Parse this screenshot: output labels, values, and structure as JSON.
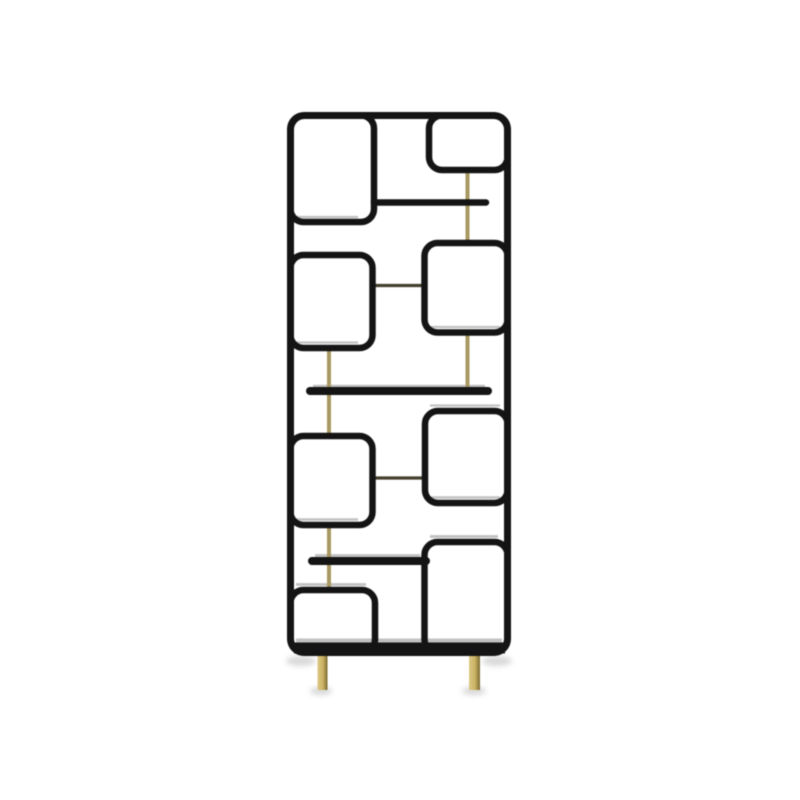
{
  "image": {
    "description": "Studio product photo of a mid-century modern room divider shelf: a tall black rounded rectangular frame containing eight rounded-corner compartments of varying sizes, three floating black shelves, slender light-brass vertical support rods, two short dark connector rods, and two brass legs, standing on a plain white background with soft floor shadows."
  },
  "palette": {
    "background": "#ffffff",
    "frame_black": "#141414",
    "brass": "#a89861",
    "connector_dark": "#45402e",
    "leg_gradient": [
      "#dcc987",
      "#c9b263",
      "#7b682f"
    ],
    "depth_gray": "#8f8f8f",
    "shadow_gray": "#bfbfbf"
  },
  "scene": {
    "canvas": {
      "width": 800,
      "height": 800
    },
    "frame": {
      "x": 290.5,
      "y": 115.5,
      "w": 217,
      "h": 537,
      "rx": 14,
      "stroke": 7
    },
    "base_rail": {
      "x1": 294,
      "y1": 648,
      "x2": 505,
      "y2": 648,
      "stroke": 11
    },
    "boxes": [
      {
        "name": "compartment-top-left",
        "x": 290.5,
        "y": 115.5,
        "w": 83.5,
        "h": 106.5,
        "rx": 13
      },
      {
        "name": "compartment-top-right",
        "x": 429.0,
        "y": 115.5,
        "w": 78.5,
        "h": 54.5,
        "rx": 13
      },
      {
        "name": "compartment-mid-left",
        "x": 290.5,
        "y": 255.0,
        "w": 82.0,
        "h": 93.0,
        "rx": 13
      },
      {
        "name": "compartment-mid-right",
        "x": 424.5,
        "y": 243.0,
        "w": 83.0,
        "h": 89.5,
        "rx": 13
      },
      {
        "name": "compartment-lower-left",
        "x": 290.5,
        "y": 436.0,
        "w": 82.0,
        "h": 89.0,
        "rx": 13
      },
      {
        "name": "compartment-lower-right",
        "x": 425.0,
        "y": 411.0,
        "w": 82.5,
        "h": 92.0,
        "rx": 13
      },
      {
        "name": "compartment-bottom-left",
        "x": 290.5,
        "y": 590.0,
        "w": 84.5,
        "h": 62.5,
        "rx": 13
      },
      {
        "name": "compartment-bottom-right",
        "x": 424.5,
        "y": 542.0,
        "w": 83.0,
        "h": 110.5,
        "rx": 13
      }
    ],
    "shelves": [
      {
        "name": "shelf-top",
        "x1": 374,
        "y1": 202.5,
        "x2": 486,
        "y2": 202.5,
        "stroke": 6.5
      },
      {
        "name": "shelf-middle",
        "x1": 310,
        "y1": 391.0,
        "x2": 488,
        "y2": 391.0,
        "stroke": 8
      },
      {
        "name": "shelf-lower",
        "x1": 312,
        "y1": 561.0,
        "x2": 426,
        "y2": 561.0,
        "stroke": 8
      }
    ],
    "brass_vertical_rods": [
      {
        "x": 467.5,
        "y1": 170.0,
        "y2": 245.0,
        "w": 4
      },
      {
        "x": 467.5,
        "y1": 332.5,
        "y2": 391.0,
        "w": 4
      },
      {
        "x": 329.0,
        "y1": 347.5,
        "y2": 436.0,
        "w": 4
      },
      {
        "x": 329.0,
        "y1": 524.5,
        "y2": 590.0,
        "w": 4
      }
    ],
    "connector_rods": [
      {
        "y": 285.5,
        "x1": 372,
        "x2": 425,
        "h": 3.2
      },
      {
        "y": 478.0,
        "x1": 372,
        "x2": 425,
        "h": 3.2
      }
    ],
    "legs": [
      {
        "x": 317.5,
        "y": 651,
        "w": 10,
        "h": 39
      },
      {
        "x": 469.0,
        "y": 651,
        "w": 11,
        "h": 39
      }
    ],
    "depth_lines": [
      {
        "x1": 296,
        "y1": 217.0,
        "x2": 358,
        "y2": 217.0,
        "w": 2.2
      },
      {
        "x1": 296,
        "y1": 342.5,
        "x2": 358,
        "y2": 342.5,
        "w": 2.2
      },
      {
        "x1": 430,
        "y1": 327.0,
        "x2": 500,
        "y2": 327.0,
        "w": 2.2
      },
      {
        "x1": 313,
        "y1": 386.0,
        "x2": 485,
        "y2": 386.0,
        "w": 2.6
      },
      {
        "x1": 430,
        "y1": 405.5,
        "x2": 500,
        "y2": 405.5,
        "w": 2.2
      },
      {
        "x1": 430,
        "y1": 497.5,
        "x2": 500,
        "y2": 497.5,
        "w": 2.6
      },
      {
        "x1": 296,
        "y1": 519.5,
        "x2": 358,
        "y2": 519.5,
        "w": 2.6
      },
      {
        "x1": 315,
        "y1": 555.5,
        "x2": 420,
        "y2": 555.5,
        "w": 2.8
      },
      {
        "x1": 430,
        "y1": 536.5,
        "x2": 498,
        "y2": 536.5,
        "w": 2.8
      },
      {
        "x1": 296,
        "y1": 584.5,
        "x2": 366,
        "y2": 584.5,
        "w": 2.8
      },
      {
        "x1": 296,
        "y1": 640.5,
        "x2": 502,
        "y2": 640.5,
        "w": 4.0
      }
    ],
    "floor_shadows": [
      {
        "cx": 301,
        "cy": 661,
        "rx": 15,
        "ry": 5
      },
      {
        "cx": 497,
        "cy": 661,
        "rx": 15,
        "ry": 5
      },
      {
        "cx": 321,
        "cy": 691,
        "rx": 11,
        "ry": 4
      },
      {
        "cx": 474,
        "cy": 691,
        "rx": 12,
        "ry": 4
      }
    ]
  }
}
